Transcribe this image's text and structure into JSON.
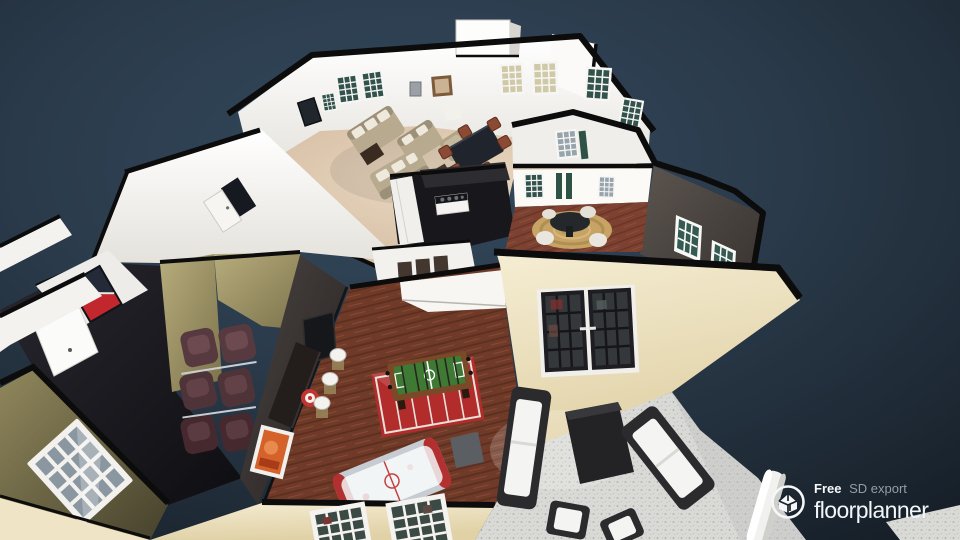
{
  "watermark": {
    "free": "Free",
    "plan": "SD export",
    "brand": "floorplanner"
  },
  "palette": {
    "bg_top": "#344a5e",
    "bg_mid": "#283848",
    "bg_edge": "#18212b",
    "outline": "#0c0c0c",
    "wall_white": "#f4f2ee",
    "wall_white_bright": "#fdfdfc",
    "wall_cream": "#efe4c4",
    "wall_cream_dark": "#e0d1a6",
    "wall_olive": "#b2a878",
    "wall_olive_dark": "#6e6644",
    "wall_charcoal": "#46403d",
    "wall_game_dark": "#3b3534",
    "floor_carpet": "#d9c2a9",
    "floor_wood": "#7c4130",
    "floor_wood_game": "#6f3a28",
    "floor_theater": "#16151a",
    "kitchen_dark": "#17171c",
    "rug_red": "#b22c2c",
    "rug_gold": "#c7a365",
    "patio_concrete": "#d8d8d5",
    "sofa_beige": "#b7aa8e",
    "pillow_white": "#efe9dd",
    "recliner_brown": "#573a3f",
    "outdoor_frame": "#2b2b2e",
    "cushion_white": "#f4f4f2",
    "window_teal": "#33524b",
    "window_gray": "#98a4ac",
    "window_warm": "#cfc9a8",
    "door_dark": "#1d1d22",
    "accent_red": "#c1272d",
    "flag_navy": "#252a38",
    "table_dark": "#20242c",
    "chair_wood": "#8a4a33",
    "foosball_green": "#3f7a35",
    "foosball_frame": "#7a4a28",
    "hockey_white": "#eef1f3",
    "bar_dark": "#262020",
    "art_orange": "#d4622a",
    "logo_white": "#f5f7f9",
    "logo_gray": "#97a0aa"
  },
  "scene": {
    "type": "floorplan-3d-dollhouse",
    "camera": "aerial-oblique",
    "rooms": [
      {
        "name": "Living room",
        "floor": "beige carpet",
        "items": [
          "beige sofas with white pillows",
          "armchair",
          "coffee table",
          "wall tv",
          "dining table with wood chairs",
          "grid windows",
          "framed art"
        ]
      },
      {
        "name": "Breakfast nook",
        "floor": "dark hardwood",
        "items": [
          "round black table",
          "round sisal rug",
          "wicker chairs",
          "charcoal accent wall with windows"
        ]
      },
      {
        "name": "Kitchen",
        "floor": "dark tile",
        "items": [
          "black countertop",
          "stove with burners",
          "white cabinets"
        ]
      },
      {
        "name": "Home theater",
        "floor": "dark charcoal",
        "items": [
          "two columns of brown recliners",
          "red and navy wall art",
          "olive walls",
          "white paneled door"
        ]
      },
      {
        "name": "Game room",
        "floor": "red-brown hardwood",
        "items": [
          "foosball table",
          "air hockey table",
          "red football-field rug",
          "dark bar wall with stools",
          "dartboard",
          "orange artwork"
        ]
      },
      {
        "name": "Patio",
        "floor": "speckled concrete",
        "items": [
          "black wicker sofas with white cushions",
          "dark coffee table",
          "lounge chairs",
          "white column"
        ]
      }
    ],
    "exterior": {
      "walls": "cream stucco",
      "trim": "black dollhouse cut outline",
      "windows": "white grid with dark teal glass",
      "doors": "black french doors"
    }
  }
}
